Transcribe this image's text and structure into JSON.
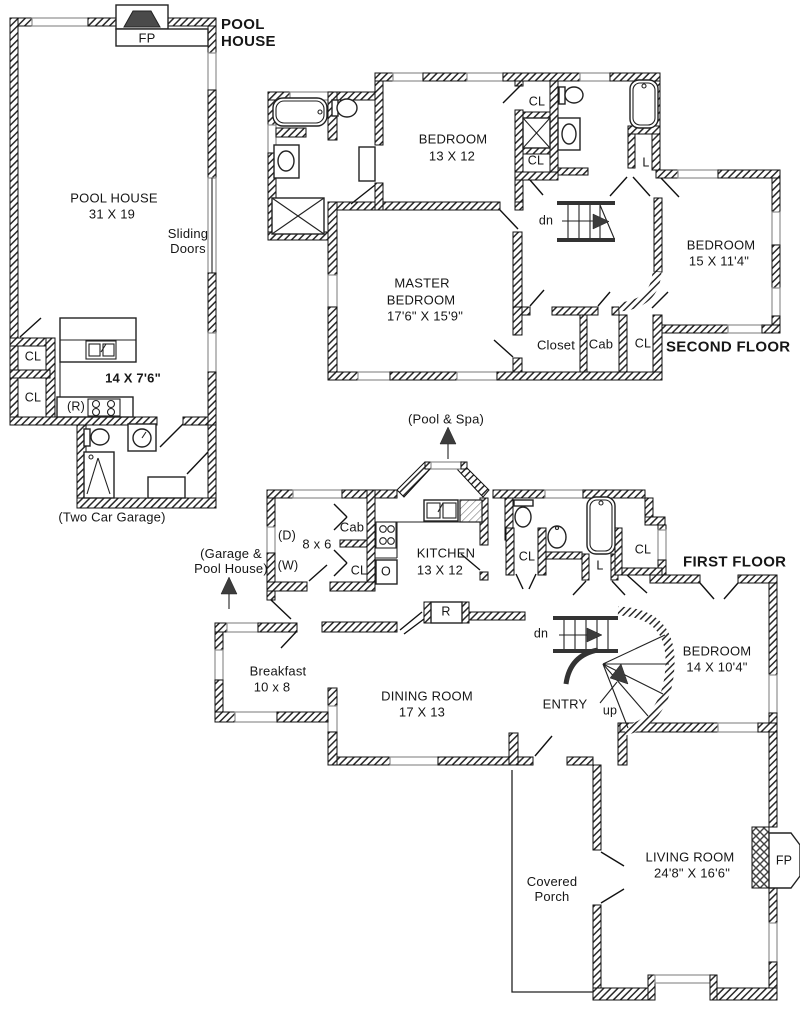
{
  "pool_house": {
    "title": "POOL\nHOUSE",
    "fireplace": "FP",
    "room_name": "POOL HOUSE",
    "room_size": "31 X 19",
    "sliding_doors": "Sliding\nDoors",
    "closet_1": "CL",
    "closet_2": "CL",
    "kitchenette_size": "14 X 7'6\"",
    "range": "(R)",
    "caption": "(Two Car Garage)"
  },
  "second_floor": {
    "title": "SECOND FLOOR",
    "bedroom1_name": "BEDROOM",
    "bedroom1_size": "13 X 12",
    "master_line1": "MASTER",
    "master_line2": "BEDROOM",
    "master_size": "17'6\" X 15'9\"",
    "bedroom2_name": "BEDROOM",
    "bedroom2_size": "15 X 11'4\"",
    "closet_top": "CL",
    "closet_mid": "CL",
    "linen": "L",
    "stairs_down": "dn",
    "closet": "Closet",
    "cabinet": "Cab",
    "closet_bottom": "CL"
  },
  "first_floor": {
    "title": "FIRST FLOOR",
    "pool_spa": "(Pool & Spa)",
    "garage_pool": "(Garage &\nPool House)",
    "dryer": "(D)",
    "washer": "(W)",
    "laundry_size": "8 x 6",
    "cabinet": "Cab",
    "laundry_closet": "CL",
    "kitchen_name": "KITCHEN",
    "kitchen_size": "13 X 12",
    "oven": "O",
    "refrigerator": "R",
    "powder_closet": "CL",
    "linen": "L",
    "bedroom_closet": "CL",
    "stairs_down": "dn",
    "stairs_up": "up",
    "entry": "ENTRY",
    "breakfast_name": "Breakfast",
    "breakfast_size": "10 x 8",
    "dining_name": "DINING ROOM",
    "dining_size": "17 X 13",
    "bedroom_name": "BEDROOM",
    "bedroom_size": "14 X 10'4\"",
    "porch": "Covered\nPorch",
    "living_name": "LIVING ROOM",
    "living_size": "24'8\" X 16'6\"",
    "fireplace": "FP"
  },
  "colors": {
    "wall_hatch": "#2a2a2a",
    "window": "#8f8f8f",
    "arrow": "#3c3c3c",
    "background": "#ffffff"
  }
}
